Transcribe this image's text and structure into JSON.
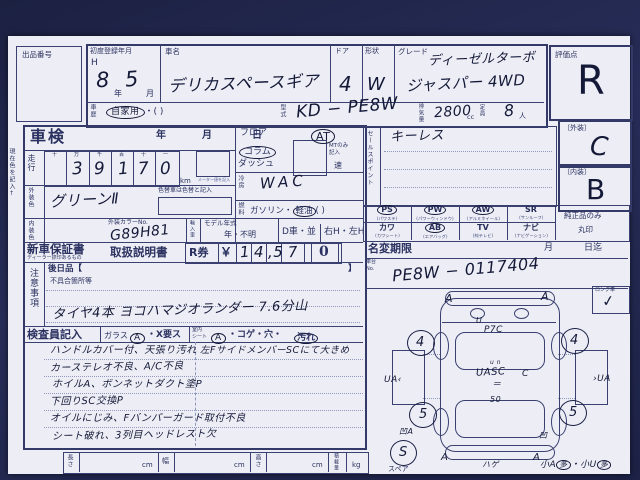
{
  "top": {
    "auction_no": "出品番号",
    "reg_label": "初度登録年月",
    "reg_era": "H",
    "reg_year": "8",
    "reg_year_u": "年",
    "reg_month": "5",
    "reg_month_u": "月",
    "name_label": "車名",
    "name_value": "デリカスペースギア",
    "door_label": "ドア",
    "door_value": "4",
    "shape_label": "形状",
    "shape_value": "W",
    "grade_label": "グレード",
    "grade_line1": "ディーゼルターボ",
    "grade_line2": "ジャスパー 4WD",
    "score_label": "評価点",
    "score_value": "R",
    "history_label": "車歴",
    "history_value": "自家用",
    "history_paren": "・(        )",
    "model_label": "型式",
    "model_value": "KD − PE8W",
    "disp_label": "排気量",
    "disp_value": "2800",
    "disp_unit": "cc",
    "cap_label": "定員",
    "cap_value": "8",
    "cap_unit": "人"
  },
  "margin_note": "現在色を記入↑",
  "shaken": {
    "label": "車検",
    "y": "年",
    "m": "月",
    "d": "日"
  },
  "run": {
    "label": "走行",
    "cols": [
      "十",
      "万",
      "千",
      "百",
      "十",
      "一"
    ],
    "digits": [
      "",
      "3",
      "9",
      "1",
      "7",
      "0"
    ],
    "unit": "km",
    "unit_note": "メーター値を記入"
  },
  "ext_color": {
    "label": "外装色",
    "value": "グリーンⅡ",
    "note": "色替車は色替と記入"
  },
  "int_color": {
    "label": "内装色"
  },
  "color_no": {
    "label": "外装カラーNo.",
    "value": "G89H81"
  },
  "import_car": {
    "label": "輸入車"
  },
  "model_year": {
    "label": "モデル年式",
    "value": "年・不明"
  },
  "dealer": {
    "d": "D車・並",
    "h": "右H・左H"
  },
  "shift": {
    "o1": "フロア",
    "o2": "コラム",
    "o3": "ダッシュ",
    "at": "AT",
    "mt1": "MTのみ",
    "mt2": "記入",
    "speed": "速"
  },
  "ac": {
    "label": "冷房",
    "value": "WAC"
  },
  "fuel": {
    "label": "燃料",
    "pre": "ガソリン・",
    "sel": "軽油",
    "post": "(      )"
  },
  "sales": {
    "label": "セールスポイント",
    "value": "キーレス"
  },
  "equip": {
    "items": [
      {
        "code": "PS",
        "sub": "(パワステ)",
        "circled": true
      },
      {
        "code": "PW",
        "sub": "(パワーウィンドウ)",
        "circled": true
      },
      {
        "code": "AW",
        "sub": "(アルミホイール)",
        "circled": true
      },
      {
        "code": "SR",
        "sub": "(サンルーフ)",
        "circled": false
      },
      {
        "code": "カワ",
        "sub": "(カワシート)",
        "circled": false
      },
      {
        "code": "AB",
        "sub": "(エアバッグ)",
        "circled": true
      },
      {
        "code": "TV",
        "sub": "(純テレビ)",
        "circled": false
      },
      {
        "code": "ナビ",
        "sub": "(ナビゲーション)",
        "circled": false
      }
    ],
    "genuine1": "純正品のみ",
    "genuine2": "丸印"
  },
  "rating": {
    "ext_label": "〔外装〕",
    "ext_value": "C",
    "int_label": "〔内装〕",
    "int_value": "B"
  },
  "warranty": {
    "label": "新車保証書",
    "sub": "ディーラー捺印あるもの",
    "manual": "取扱説明書",
    "r": "R券",
    "yen": "￥",
    "d1": "1",
    "d2": "4",
    "d3": ",5",
    "d4": "7",
    "d5": "0"
  },
  "namechange": {
    "label": "名変期限",
    "m": "月",
    "d": "日迄"
  },
  "chassis": {
    "label1": "車台",
    "label2": "No.",
    "value": "PE8W − 0117404"
  },
  "notice": {
    "label": "注意事項",
    "later": "後日品【",
    "later_close": "】",
    "defect": "不具合箇所等",
    "note": "タイヤ4本 ヨコハマジオランダー 7.6分山"
  },
  "inspector": {
    "label": "検査員記入",
    "glass": "ガラス",
    "glass_a": "A",
    "glass_x": "・X要ス",
    "seat1": "室内",
    "seat2": "シート",
    "seat_a": "A",
    "seat_rest": "・コゲ・穴・",
    "seat_dirt": "汚れ"
  },
  "notes": {
    "left": [
      "ハンドルカバー付、天張り汚れ",
      "カーステレオ不良、A/C不良",
      "ホイルA、ボンネットダクト塗P",
      "下回りSC交換P",
      "オイルにじみ、Fバンパーガード取付不良",
      "シート破れ、3列目ヘッドレスト欠"
    ],
    "right": "左FサイドメンバーSCにて大きめ"
  },
  "measure": {
    "l": "長さ",
    "w": "幅",
    "h": "高さ",
    "load": "積載量",
    "cm": "cm",
    "kg": "kg"
  },
  "diagram": {
    "long_label": "ロング車",
    "long_check": "✓",
    "a_tl": "A",
    "a_tr": "A",
    "hood1": "U",
    "hood2": "P7C",
    "c_small": "u n",
    "c_main": "UASC",
    "c_c": "C",
    "c_eq": "＝",
    "c_50": "50",
    "w_fl": "4",
    "w_fr": "4",
    "w_rl": "5",
    "w_rr": "5",
    "side_l": "UA‹",
    "side_r": "›UA",
    "r_l": "凹A",
    "r_r": "凹",
    "b_l": "A",
    "b_r": "A",
    "b_c": "ハゲ",
    "spare": "S",
    "spare_label": "スペア",
    "small1": "小A",
    "small1c": "多",
    "small2": "・小U",
    "small2c": "多"
  }
}
